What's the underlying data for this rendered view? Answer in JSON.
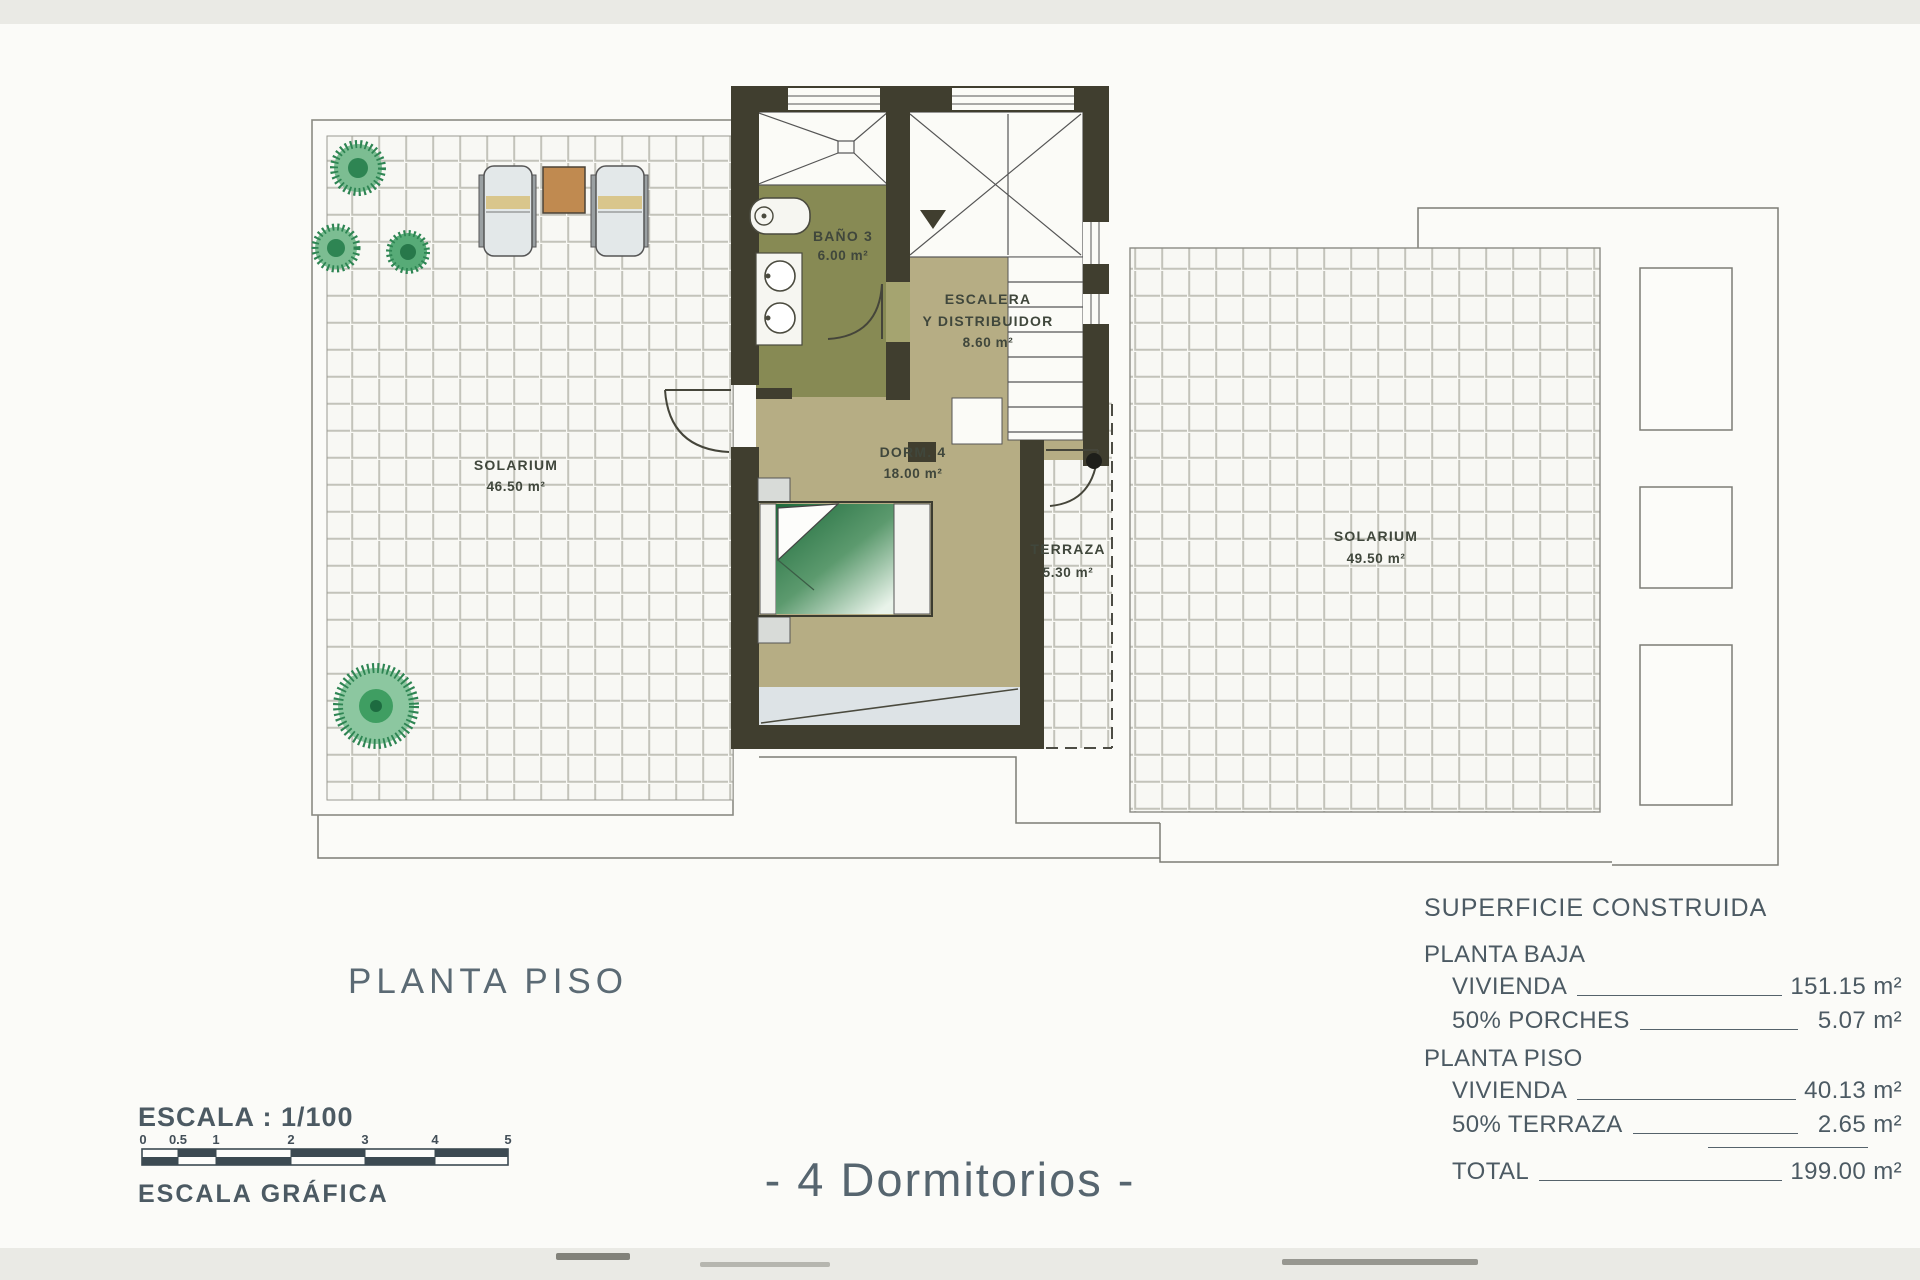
{
  "document": {
    "plan_title": "PLANTA PISO",
    "caption": "- 4 Dormitorios -"
  },
  "scale": {
    "label": "ESCALA : 1/100",
    "graphic_label": "ESCALA GRÁFICA",
    "ticks": [
      "0",
      "0.5",
      "1",
      "2",
      "3",
      "4",
      "5"
    ]
  },
  "rooms": {
    "solarium_left": {
      "name": "SOLARIUM",
      "area": "46.50 m²"
    },
    "bano3": {
      "name": "BAÑO 3",
      "area": "6.00 m²"
    },
    "escalera": {
      "name_line1": "ESCALERA",
      "name_line2": "Y DISTRIBUIDOR",
      "area": "8.60 m²"
    },
    "dorm4": {
      "name": "DORM. 4",
      "area": "18.00 m²"
    },
    "terraza": {
      "name": "TERRAZA",
      "area": "5.30 m²"
    },
    "solarium_right": {
      "name": "SOLARIUM",
      "area": "49.50 m²"
    }
  },
  "area_table": {
    "title": "SUPERFICIE CONSTRUIDA",
    "sections": [
      {
        "heading": "PLANTA BAJA",
        "rows": [
          {
            "label": "VIVIENDA",
            "value": "151.15 m²"
          },
          {
            "label": "50% PORCHES",
            "value": "5.07 m²"
          }
        ]
      },
      {
        "heading": "PLANTA PISO",
        "rows": [
          {
            "label": "VIVIENDA",
            "value": "40.13 m²"
          },
          {
            "label": "50% TERRAZA",
            "value": "2.65 m²"
          }
        ]
      }
    ],
    "total_label": "TOTAL",
    "total_value": "199.00 m²"
  },
  "colors": {
    "wall": "#403e2f",
    "bath_floor": "#878a54",
    "room_floor": "#b6ad84",
    "tile_grout": "#c3c3ba",
    "text_blue_gray": "#4c5a63",
    "bed_green": "#1e6b3c",
    "plant_green": "#2e8553",
    "table_wood": "#c08a50"
  }
}
